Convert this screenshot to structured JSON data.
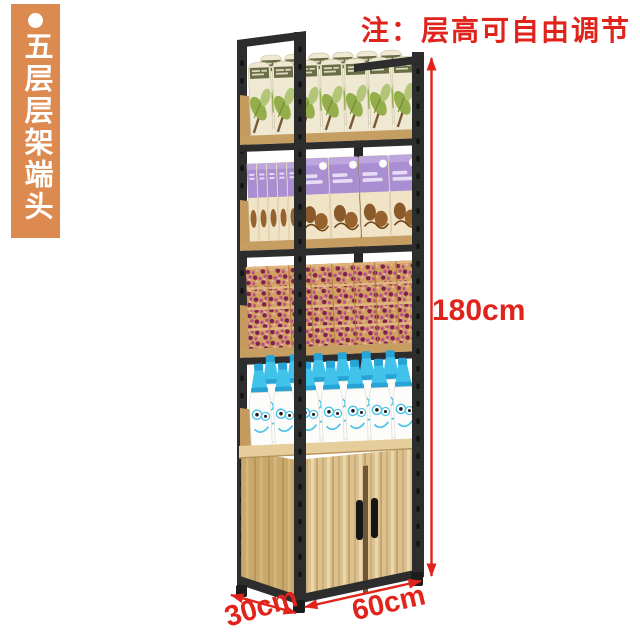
{
  "banner": {
    "label": "五层层架端头",
    "background_color": "#dd8a50",
    "text_color": "#ffffff"
  },
  "note": {
    "text": "注：层高可自由调节",
    "color": "#e0241c"
  },
  "dimensions": {
    "height": "180cm",
    "depth": "30cm",
    "width": "60cm",
    "annotation_color": "#e0241c"
  },
  "shelf": {
    "tier_count": 5,
    "frame_color": "#2d2d2d",
    "board_color": "#c79e62",
    "cabinet_wood_color": "#dcc190",
    "tiers": [
      "tea-packages",
      "chocolate-boxes",
      "patterned-snack-boxes",
      "smiley-bottles",
      "two-door-cabinet"
    ]
  }
}
